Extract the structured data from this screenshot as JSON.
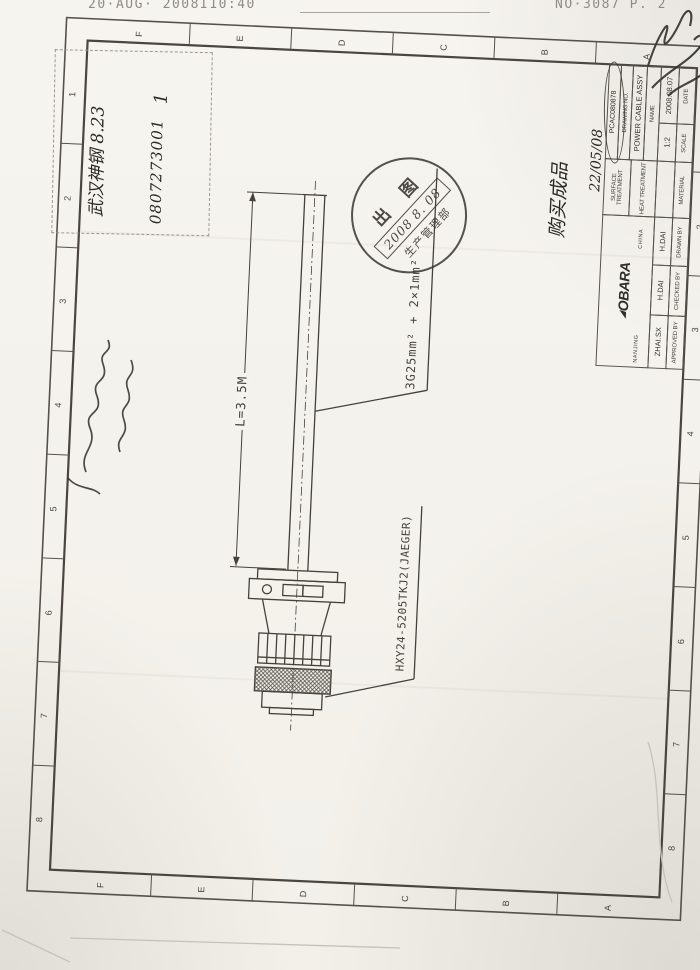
{
  "page": {
    "fax_left": "20·AUG· 2008I10:40",
    "fax_right": "NO·3087   P. 2"
  },
  "grid": {
    "letters": [
      "F",
      "E",
      "D",
      "C",
      "B",
      "A"
    ],
    "numbers": [
      "1",
      "2",
      "3",
      "4",
      "5",
      "6",
      "7",
      "8"
    ]
  },
  "annotations": {
    "box_line1": "武汉神钢  8.23",
    "box_line2": "0807273001",
    "box_mark": "1",
    "purchase_line1": "购买成品",
    "purchase_line2": "22/05/08"
  },
  "stamp": {
    "title": "出 图",
    "date": "2008 8. 08",
    "department": "生产管理部"
  },
  "drawing": {
    "cable_spec": "3G25mm² + 2×1mm²",
    "cable_length": "L=3.5M",
    "connector_model": "HXY24-5205TKJ2(JAEGER)"
  },
  "title_block": {
    "columns": [
      {
        "label": "APPROVED BY",
        "value": "ZHAI.SX"
      },
      {
        "label": "CHECKED BY",
        "value": "H.DAI"
      },
      {
        "label": "DRAWN BY",
        "value": "H.DAI"
      },
      {
        "label": "MATERIAL",
        "value": ""
      },
      {
        "label": "SCALE",
        "value": "1:2"
      },
      {
        "label": "DATE",
        "value": "2008.08.07"
      }
    ],
    "company": {
      "left": "NANJING",
      "mark": "◢",
      "logo": "OBARA",
      "right": "CHINA"
    },
    "heat_treatment": "HEAT TREATMENT",
    "surface_treatment": "SURFACE TREATMENT",
    "name_label": "NAME",
    "name_value": "POWER CABLE ASSY",
    "drawing_no_label": "DRAWING NO.",
    "drawing_no_value": "PCAC080878"
  },
  "colors": {
    "ink": "#45423c",
    "frame": "#4a463f",
    "paper": "#f5f3ee",
    "stamp": "#3e3b36"
  }
}
